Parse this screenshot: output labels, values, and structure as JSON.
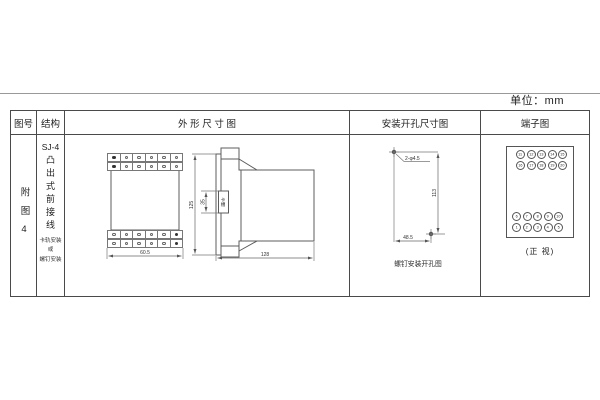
{
  "sheet": {
    "units": "单位：mm"
  },
  "table": {
    "headers": {
      "fig_no": "图号",
      "structure": "结构",
      "outline": "外 形 尺 寸 图",
      "mounting": "安装开孔尺寸图",
      "terminal": "端子图"
    }
  },
  "fig_cell": {
    "label": "附图4"
  },
  "structure_cell": {
    "model": "SJ-4",
    "type": "凸出式前接线",
    "note_lines": [
      "卡轨安装",
      "或",
      "螺钉安装"
    ]
  },
  "outline_view": {
    "front_width": "60.5",
    "side_height": "125",
    "slot_dim": "35",
    "slot_label": "卡槽",
    "side_depth": "128"
  },
  "mounting_view": {
    "hole_label": "2-φ4.5",
    "height_dim": "113",
    "width_dim": "48.5",
    "caption": "螺钉安装开孔图"
  },
  "terminal_view": {
    "top_rows": [
      [
        "11",
        "12",
        "13",
        "14",
        "15"
      ],
      [
        "16",
        "17",
        "18",
        "19",
        "20"
      ]
    ],
    "bottom_rows": [
      [
        "6",
        "7",
        "8",
        "9",
        "10"
      ],
      [
        "1",
        "2",
        "3",
        "4",
        "5"
      ]
    ],
    "caption": "(正 视)"
  },
  "colors": {
    "line": "#5c5c5c",
    "table_border": "#4a4a4a",
    "text": "#333333"
  }
}
